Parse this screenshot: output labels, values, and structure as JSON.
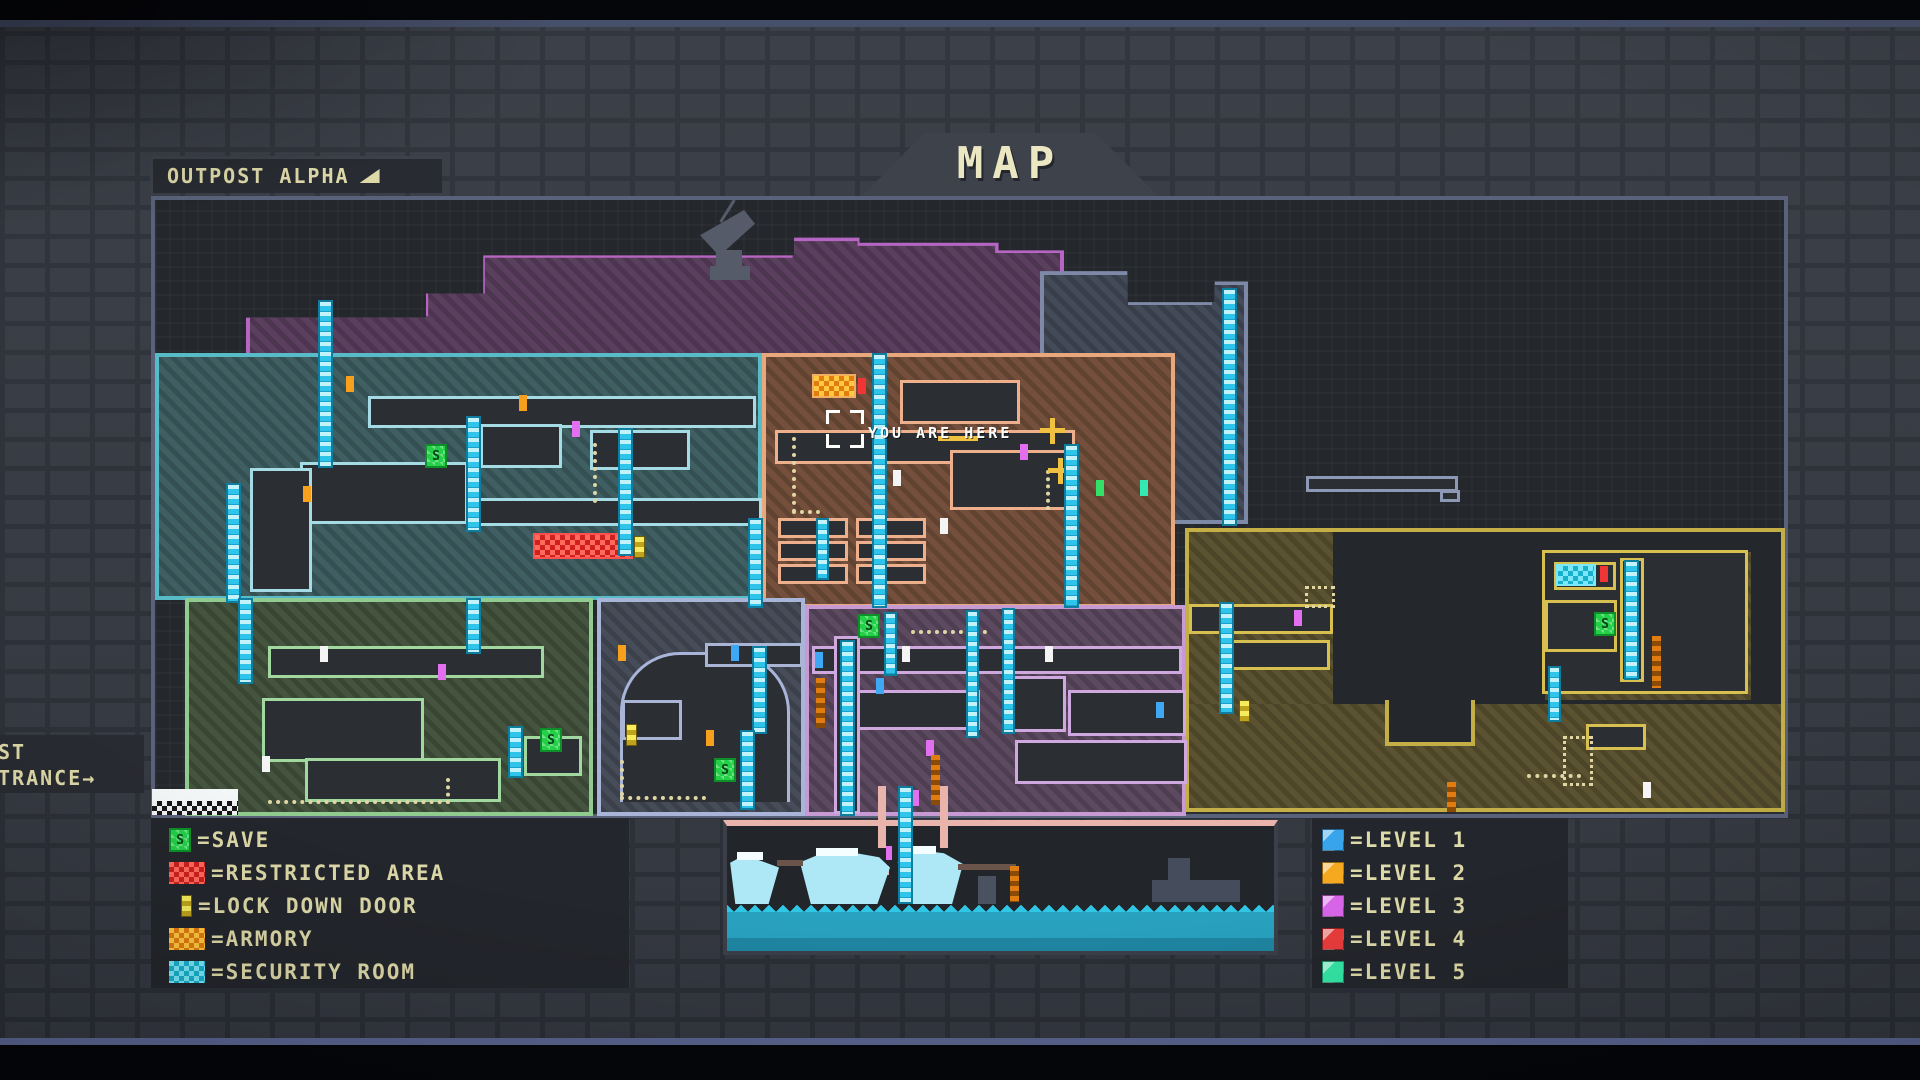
{
  "header": {
    "zone_label": "OUTPOST ALPHA",
    "title": "MAP"
  },
  "entrance": {
    "line1": "ST",
    "line2": "TRANCE→"
  },
  "player_marker": {
    "label": "YOU ARE HERE"
  },
  "icons": {
    "save_letter": "S"
  },
  "legend_features": {
    "items": [
      {
        "name": "save",
        "label": "=SAVE",
        "color": "#23d048"
      },
      {
        "name": "restricted-area",
        "label": "=RESTRICTED AREA",
        "color": "#e03838"
      },
      {
        "name": "lock-down-door",
        "label": "=LOCK DOWN DOOR",
        "color": "#f2e24a"
      },
      {
        "name": "armory",
        "label": "=ARMORY",
        "color": "#f09a1c"
      },
      {
        "name": "security-room",
        "label": "=SECURITY ROOM",
        "color": "#2fd4e8"
      }
    ]
  },
  "legend_levels": {
    "items": [
      {
        "label": "=LEVEL 1",
        "color": "#38a4ec"
      },
      {
        "label": "=LEVEL 2",
        "color": "#f6a81e"
      },
      {
        "label": "=LEVEL 3",
        "color": "#da66ea"
      },
      {
        "label": "=LEVEL 4",
        "color": "#ea3c3c"
      },
      {
        "label": "=LEVEL 5",
        "color": "#33e8a6"
      }
    ]
  },
  "map": {
    "regions": [
      {
        "name": "upper-ridge",
        "outline": "#b765c2",
        "fill": "#5a3f5e"
      },
      {
        "name": "northwest-complex",
        "outline": "#58bcc8",
        "fill": "#3f5f63"
      },
      {
        "name": "central-complex",
        "outline": "#e8a87c",
        "fill": "#74503c"
      },
      {
        "name": "upper-east-tower",
        "outline": "#7d89a6",
        "fill": "#434a58"
      },
      {
        "name": "southwest-wing",
        "outline": "#90cc90",
        "fill": "#44543e"
      },
      {
        "name": "south-bunker",
        "outline": "#a8b4d8",
        "fill": "#474c59"
      },
      {
        "name": "south-central-wing",
        "outline": "#c79ad4",
        "fill": "#5d4a60"
      },
      {
        "name": "east-canyon",
        "outline": "#c3af45",
        "fill": "#5a5230"
      },
      {
        "name": "underwater-dock",
        "outline": "#e8b4ac",
        "fill": "#22252a"
      }
    ],
    "water_color": "#28a2c0",
    "ladder_color": "#2fc4ea"
  }
}
